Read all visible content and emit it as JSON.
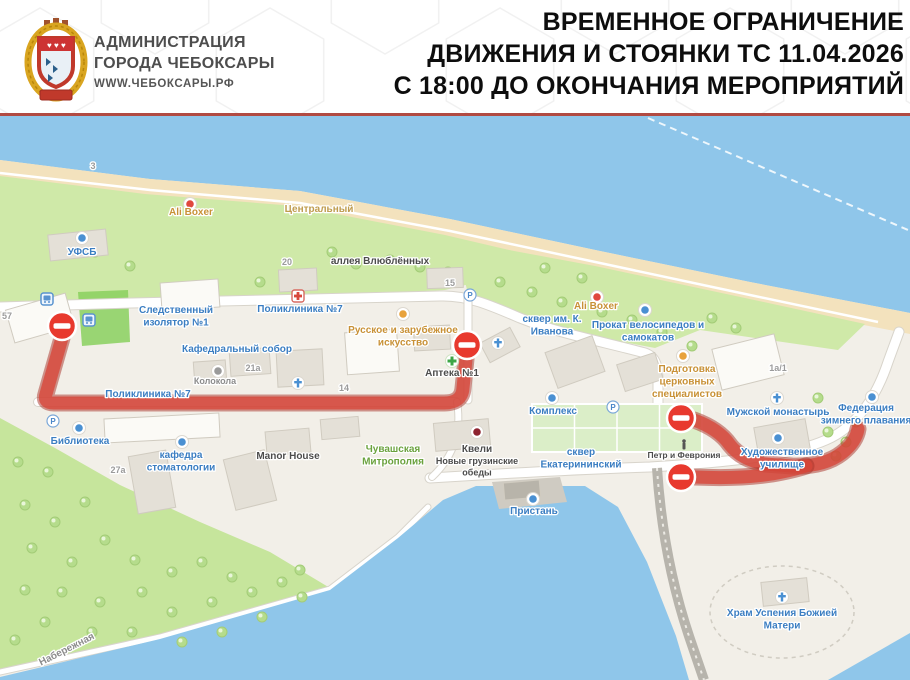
{
  "header": {
    "org_line1": "АДМИНИСТРАЦИЯ",
    "org_line2": "ГОРОДА ЧЕБОКСАРЫ",
    "website": "WWW.ЧЕБОКСАРЫ.РФ",
    "title_line1": "ВРЕМЕННОЕ ОГРАНИЧЕНИЕ",
    "title_line2": "ДВИЖЕНИЯ И СТОЯНКИ ТС 11.04.2026",
    "title_line3": "С 18:00 ДО ОКОНЧАНИЯ МЕРОПРИЯТИЙ"
  },
  "map": {
    "colors": {
      "water": "#8fc6ea",
      "sand": "#f3e2bd",
      "land": "#f2efe8",
      "green": "#cfe9a8",
      "forest": "#c6e59c",
      "lawn": "#8ad05e",
      "square_green": "#dbeec8",
      "road_fill": "#ffffff",
      "road_casing": "#d8d4cb",
      "building": "#e4e0d7",
      "building_stroke": "#d0cbc0",
      "route_main": "#d8473b",
      "route_casing": "#a83228",
      "sign_red": "#e8392e",
      "label_blue": "#3b7ec2",
      "label_orange": "#c89136",
      "label_brown": "#bf9c4e",
      "label_green": "#6ba23e",
      "label_dark": "#4c4c4c",
      "label_gray": "#8c8c8c",
      "label_num": "#9b9b9b"
    },
    "base": {
      "river": "M0,115 L910,115 L910,313 L750,282 L600,251 L450,219 L300,191 L150,179 L0,160 Z",
      "sand": "M0,160 L150,179 L300,191 L450,219 L600,251 L750,282 L910,313 L910,334 L745,302 L595,268 L445,237 L295,208 L145,196 L0,178 Z",
      "beach_extra": "M85,182 L430,228 L435,250 L240,228 L85,202 Z",
      "green_top": "M0,176 L145,194 L295,206 L445,235 L560,262 L445,290 L250,300 L0,305 Z",
      "green_skver": "M455,240 L595,266 L745,298 L865,324 L838,350 L700,330 L655,348 L560,330 L468,294 Z",
      "lawn": "M78,292 L128,290 L130,342 L82,346 Z",
      "forest": "M0,418 L55,448 L120,485 L200,522 L270,552 L330,588 L160,638 L0,674 Z",
      "bay": "M0,680 L0,677 L160,639 L330,590 L398,538 L443,500 L476,486 L585,486 L618,507 L647,562 L676,636 L689,680 Z",
      "corner_water": "M910,633 L910,680 L828,680 Z",
      "pier": "M492,482 L560,477 L567,502 L499,509 Z",
      "river_dash": "M648,118 L908,230",
      "temple_path_cx": 782,
      "temple_path_cy": 612,
      "temple_path_rx": 72,
      "temple_path_ry": 46,
      "ekat_square": {
        "x": 532,
        "y": 404,
        "w": 170,
        "h": 48
      }
    },
    "roads": [
      {
        "d": "M0,307 C150,302 320,298 440,296 C468,295 492,306 520,318 C560,334 605,342 645,353 C656,357 658,366 658,382 L658,452",
        "w": 9
      },
      {
        "d": "M38,402 L456,402",
        "w": 8
      },
      {
        "d": "M468,294 L468,400",
        "w": 7
      },
      {
        "d": "M430,478 C510,473 585,469 650,467 C735,462 792,455 826,440 C856,427 876,398 888,362 L899,332",
        "w": 9
      },
      {
        "d": "M457,402 C463,438 448,462 432,477",
        "w": 6
      },
      {
        "d": "M0,672 L160,637 L330,589 L398,537 L428,507",
        "w": 5
      }
    ],
    "dam_road": {
      "d": "M657,468 C661,530 673,590 691,642 L704,680",
      "w": 10
    },
    "shore_path": {
      "d": "M0,173 L150,190 L300,203 L450,231 L600,263 L750,295 L878,322",
      "w": 2.5
    },
    "buildings": [
      [
        40,
        318,
        62,
        34,
        -16,
        "#fbfaf6"
      ],
      [
        78,
        245,
        58,
        26,
        -6,
        null
      ],
      [
        190,
        295,
        58,
        28,
        -4,
        "#fbfaf6"
      ],
      [
        298,
        280,
        38,
        22,
        -3,
        null
      ],
      [
        445,
        278,
        36,
        20,
        -2,
        null
      ],
      [
        250,
        362,
        40,
        26,
        -4,
        null
      ],
      [
        300,
        368,
        46,
        36,
        -3,
        null
      ],
      [
        372,
        352,
        52,
        42,
        -4,
        "#fbfaf6"
      ],
      [
        432,
        338,
        36,
        24,
        -3,
        null
      ],
      [
        500,
        345,
        34,
        22,
        -28,
        null
      ],
      [
        575,
        362,
        50,
        38,
        -20,
        null
      ],
      [
        162,
        428,
        115,
        24,
        -3,
        "#fbfaf6"
      ],
      [
        152,
        482,
        38,
        58,
        -10,
        null
      ],
      [
        250,
        480,
        42,
        52,
        -14,
        null
      ],
      [
        288,
        442,
        44,
        24,
        -5,
        null
      ],
      [
        340,
        428,
        38,
        20,
        -5,
        null
      ],
      [
        462,
        435,
        55,
        28,
        -5,
        null
      ],
      [
        748,
        362,
        64,
        42,
        -14,
        "#fbfaf6"
      ],
      [
        782,
        438,
        52,
        30,
        -10,
        null
      ],
      [
        785,
        592,
        46,
        24,
        -6,
        null
      ],
      [
        210,
        372,
        32,
        22,
        -4,
        null
      ],
      [
        640,
        372,
        40,
        28,
        -18,
        null
      ],
      [
        522,
        490,
        36,
        17,
        -5,
        "#b8b4aa"
      ]
    ],
    "trees": [
      [
        18,
        462
      ],
      [
        48,
        472
      ],
      [
        25,
        505
      ],
      [
        55,
        522
      ],
      [
        85,
        502
      ],
      [
        32,
        548
      ],
      [
        72,
        562
      ],
      [
        105,
        540
      ],
      [
        135,
        560
      ],
      [
        62,
        592
      ],
      [
        100,
        602
      ],
      [
        142,
        592
      ],
      [
        172,
        572
      ],
      [
        202,
        562
      ],
      [
        232,
        577
      ],
      [
        172,
        612
      ],
      [
        212,
        602
      ],
      [
        252,
        592
      ],
      [
        282,
        582
      ],
      [
        132,
        632
      ],
      [
        92,
        632
      ],
      [
        45,
        622
      ],
      [
        182,
        642
      ],
      [
        222,
        632
      ],
      [
        262,
        617
      ],
      [
        302,
        597
      ],
      [
        25,
        590
      ],
      [
        300,
        570
      ],
      [
        15,
        640
      ],
      [
        95,
        252
      ],
      [
        130,
        266
      ],
      [
        260,
        282
      ],
      [
        300,
        287
      ],
      [
        332,
        252
      ],
      [
        356,
        264
      ],
      [
        390,
        260
      ],
      [
        420,
        267
      ],
      [
        448,
        272
      ],
      [
        500,
        282
      ],
      [
        532,
        292
      ],
      [
        562,
        302
      ],
      [
        602,
        312
      ],
      [
        632,
        320
      ],
      [
        662,
        332
      ],
      [
        692,
        346
      ],
      [
        545,
        268
      ],
      [
        582,
        278
      ],
      [
        712,
        318
      ],
      [
        736,
        328
      ],
      [
        828,
        432
      ],
      [
        846,
        442
      ],
      [
        856,
        422
      ],
      [
        836,
        456
      ],
      [
        818,
        398
      ]
    ],
    "restricted_routes": [
      "M62,338 L46,394 Q43,403 54,403 L444,403 Q462,403 463,388 L466,359",
      "M694,420 Q719,429 730,445 Q742,460 765,464 L792,466 Q824,467 842,453 Q856,442 858,429",
      "M695,477 Q740,479 772,474 Q794,470 806,466"
    ],
    "no_entry_signs": [
      [
        62,
        326
      ],
      [
        467,
        345
      ],
      [
        681,
        418
      ],
      [
        681,
        477
      ]
    ],
    "icons": [
      {
        "k": "bus",
        "x": 47,
        "y": 299
      },
      {
        "k": "bus",
        "x": 89,
        "y": 320
      },
      {
        "k": "parking",
        "x": 470,
        "y": 295
      },
      {
        "k": "parking",
        "x": 613,
        "y": 407
      },
      {
        "k": "parking",
        "x": 53,
        "y": 421
      },
      {
        "k": "dot",
        "c": "#e0483e",
        "x": 190,
        "y": 204
      },
      {
        "k": "dot",
        "c": "#e0483e",
        "x": 597,
        "y": 297
      },
      {
        "k": "dot",
        "c": "#4a90d2",
        "x": 82,
        "y": 238
      },
      {
        "k": "dot",
        "c": "#4a90d2",
        "x": 645,
        "y": 310
      },
      {
        "k": "dot",
        "c": "#4a90d2",
        "x": 552,
        "y": 398
      },
      {
        "k": "dot",
        "c": "#4a90d2",
        "x": 79,
        "y": 428
      },
      {
        "k": "dot",
        "c": "#4a90d2",
        "x": 182,
        "y": 442
      },
      {
        "k": "dot",
        "c": "#4a90d2",
        "x": 778,
        "y": 438
      },
      {
        "k": "dot",
        "c": "#4a90d2",
        "x": 533,
        "y": 499
      },
      {
        "k": "dot",
        "c": "#4a90d2",
        "x": 872,
        "y": 397
      },
      {
        "k": "dot",
        "c": "#e8a23c",
        "x": 403,
        "y": 314
      },
      {
        "k": "dot",
        "c": "#e8a23c",
        "x": 683,
        "y": 356
      },
      {
        "k": "dot",
        "c": "#8e2430",
        "x": 477,
        "y": 432
      },
      {
        "k": "dot",
        "c": "#9a9a9a",
        "x": 218,
        "y": 371
      },
      {
        "k": "church",
        "x": 498,
        "y": 343
      },
      {
        "k": "church",
        "x": 298,
        "y": 383
      },
      {
        "k": "church",
        "x": 777,
        "y": 398
      },
      {
        "k": "church",
        "x": 782,
        "y": 597
      },
      {
        "k": "pharmacy",
        "x": 452,
        "y": 361
      },
      {
        "k": "clinic",
        "x": 298,
        "y": 296
      },
      {
        "k": "statue",
        "x": 684,
        "y": 445
      }
    ],
    "labels": [
      {
        "lines": [
          "УФСБ"
        ],
        "x": 82,
        "y": 255,
        "c": "blue"
      },
      {
        "lines": [
          "Следственный",
          "изолятор №1"
        ],
        "x": 176,
        "y": 313,
        "c": "blue"
      },
      {
        "lines": [
          "Поликлиника №7"
        ],
        "x": 300,
        "y": 312,
        "c": "blue"
      },
      {
        "lines": [
          "Кафедральный собор"
        ],
        "x": 237,
        "y": 352,
        "c": "blue"
      },
      {
        "lines": [
          "Поликлиника №7"
        ],
        "x": 148,
        "y": 397,
        "c": "blue"
      },
      {
        "lines": [
          "Колокола"
        ],
        "x": 215,
        "y": 384,
        "c": "gray",
        "s": 9
      },
      {
        "lines": [
          "Библиотека"
        ],
        "x": 80,
        "y": 444,
        "c": "blue"
      },
      {
        "lines": [
          "кафедра",
          "стоматологии"
        ],
        "x": 181,
        "y": 458,
        "c": "blue"
      },
      {
        "lines": [
          "сквер им. К.",
          "Иванова"
        ],
        "x": 552,
        "y": 322,
        "c": "blue"
      },
      {
        "lines": [
          "Прокат велосипедов и",
          "самокатов"
        ],
        "x": 648,
        "y": 328,
        "c": "blue"
      },
      {
        "lines": [
          "Комплекс"
        ],
        "x": 553,
        "y": 414,
        "c": "blue"
      },
      {
        "lines": [
          "сквер",
          "Екатерининский"
        ],
        "x": 581,
        "y": 455,
        "c": "blue"
      },
      {
        "lines": [
          "Пристань"
        ],
        "x": 534,
        "y": 514,
        "c": "blue"
      },
      {
        "lines": [
          "Мужской монастырь"
        ],
        "x": 778,
        "y": 415,
        "c": "blue"
      },
      {
        "lines": [
          "Федерация",
          "зимнего плавания"
        ],
        "x": 866,
        "y": 411,
        "c": "blue"
      },
      {
        "lines": [
          "Художественное",
          "училище"
        ],
        "x": 782,
        "y": 455,
        "c": "blue"
      },
      {
        "lines": [
          "Храм Успения Божией",
          "Матери"
        ],
        "x": 782,
        "y": 616,
        "c": "blue"
      },
      {
        "lines": [
          "Ali Boxer"
        ],
        "x": 191,
        "y": 215,
        "c": "orange"
      },
      {
        "lines": [
          "Ali Boxer"
        ],
        "x": 596,
        "y": 309,
        "c": "orange"
      },
      {
        "lines": [
          "Центральный"
        ],
        "x": 319,
        "y": 212,
        "c": "brown"
      },
      {
        "lines": [
          "Русское и зарубежное",
          "искусство"
        ],
        "x": 403,
        "y": 333,
        "c": "orange"
      },
      {
        "lines": [
          "Подготовка",
          "церковных",
          "специалистов"
        ],
        "x": 687,
        "y": 372,
        "c": "orange"
      },
      {
        "lines": [
          "Аптека №1"
        ],
        "x": 452,
        "y": 376,
        "c": "dark"
      },
      {
        "lines": [
          "Чувашская",
          "Митрополия"
        ],
        "x": 393,
        "y": 452,
        "c": "green"
      },
      {
        "lines": [
          "аллея Влюблённых"
        ],
        "x": 380,
        "y": 264,
        "c": "dark"
      },
      {
        "lines": [
          "Manor House"
        ],
        "x": 288,
        "y": 459,
        "c": "dark"
      },
      {
        "lines": [
          "Квели"
        ],
        "x": 477,
        "y": 452,
        "c": "dark"
      },
      {
        "lines": [
          "Новые грузинские",
          "обеды"
        ],
        "x": 477,
        "y": 464,
        "c": "dark",
        "s": 9
      },
      {
        "lines": [
          "Петр и Феврония"
        ],
        "x": 684,
        "y": 458,
        "c": "dark",
        "s": 8.5
      },
      {
        "lines": [
          "Набережная"
        ],
        "x": 68,
        "y": 652,
        "c": "gray",
        "s": 10,
        "r": -27
      },
      {
        "lines": [
          "3"
        ],
        "x": 93,
        "y": 169,
        "c": "num",
        "s": 9
      },
      {
        "lines": [
          "57"
        ],
        "x": 7,
        "y": 319,
        "c": "num",
        "s": 9
      },
      {
        "lines": [
          "20"
        ],
        "x": 287,
        "y": 265,
        "c": "num",
        "s": 9
      },
      {
        "lines": [
          "15"
        ],
        "x": 450,
        "y": 286,
        "c": "num",
        "s": 9
      },
      {
        "lines": [
          "21а"
        ],
        "x": 253,
        "y": 371,
        "c": "num",
        "s": 9
      },
      {
        "lines": [
          "14"
        ],
        "x": 344,
        "y": 391,
        "c": "num",
        "s": 9
      },
      {
        "lines": [
          "27а"
        ],
        "x": 118,
        "y": 473,
        "c": "num",
        "s": 9
      },
      {
        "lines": [
          "1а/1"
        ],
        "x": 778,
        "y": 371,
        "c": "num",
        "s": 9
      }
    ]
  }
}
